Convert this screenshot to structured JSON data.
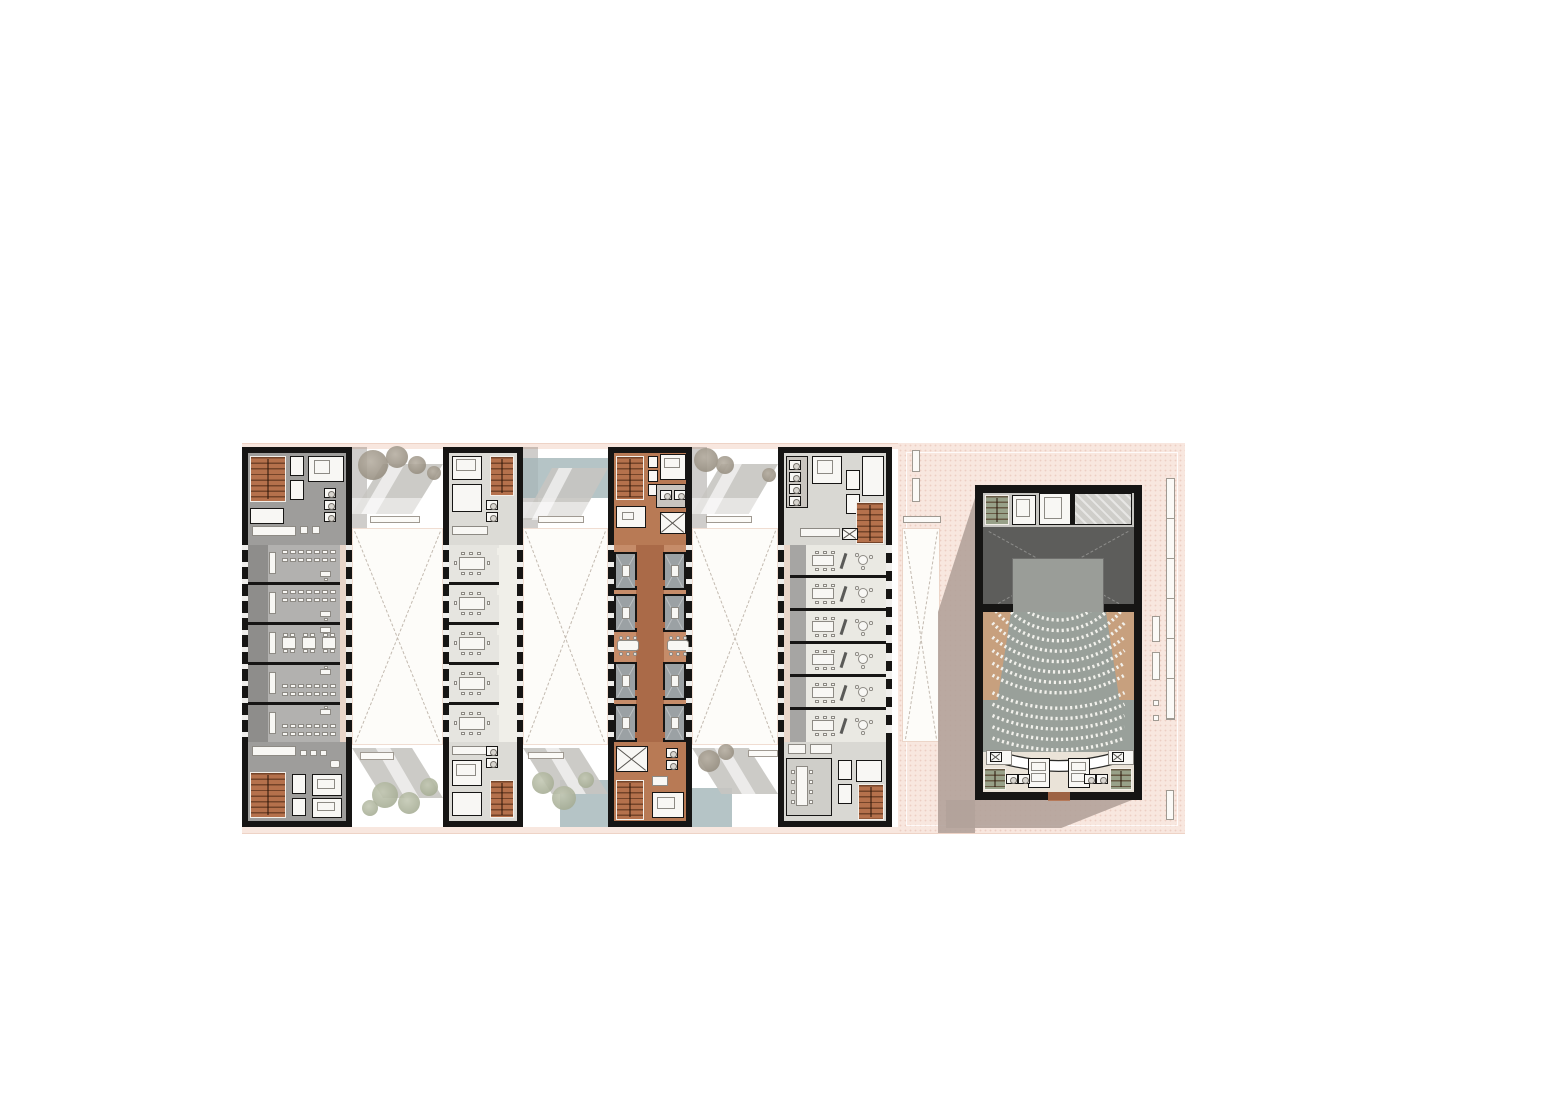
{
  "meta": {
    "kind": "architectural-floor-plan",
    "description": "Rendered ground-floor plan: four parallel building wings connected by landscaped courtyards, with a freestanding auditorium on a pink plaza at the right.",
    "visible_text": ""
  },
  "palette": {
    "wall": "#161514",
    "white": "#f8f7f4",
    "plaza": "#f8e7df",
    "plaza_line": "#eed3c6",
    "courtyard": "#fdfcf9",
    "courtyard_line": "#f0ddd2",
    "cross_dash": "#c3bab0",
    "stair": "#b5714c",
    "stair_tread": "rgba(62,30,12,0.55)",
    "green_stair": "#98a189",
    "shadow": "#b2a29a",
    "band_shadow": "rgba(95,88,82,0.30)",
    "path_grey": "#c6c5c1",
    "path_overlay": "rgba(255,255,255,0.62)",
    "water": "#a3b5b8",
    "tree_sage_1": "#c2c7b2",
    "tree_sage_2": "#a4ab92",
    "tree_taupe_1": "#b5ada0",
    "tree_taupe_2": "#948c7e",
    "bench": "#fbfaf7",
    "bench_line": "#a09a92",
    "gallery": "#e9d6ca",
    "bar1_floor": "#b2b1af",
    "bar1_corridor": "#8e8d8b",
    "bar1_core": "#9e9d9b",
    "bar2_floor": "#e6e5e0",
    "bar2_corridor": "#f0efe9",
    "bar2_core": "#dcdbd6",
    "bar3_floor": "#c68c69",
    "bar3_corridor": "#aa6a48",
    "bar3_room": "#9ba1a4",
    "bar3_core": "#b87a55",
    "bar4_floor": "#eae9e3",
    "bar4_corridor": "#a6a5a3",
    "bar4_core": "#d9d8d3",
    "bar4_pantry": "#cfcec9",
    "furniture": "#f8f7f4",
    "furniture_line": "#8d8a84",
    "divider": "#5a5a58",
    "wc_floor": "#c9c5bf",
    "backstage": "#c7c6c2",
    "stage": "#5d5d5b",
    "stage_dash": "#8d8d8b",
    "apron": "#9a9d98",
    "apron_line": "#6f6f6d",
    "seating": "#99a09a",
    "seat": "#f2f1ec",
    "wedge": "#c7a07e",
    "lobby": "#eae3d8",
    "counter_edge": "#2c2c2a",
    "entry": "#b5714c"
  },
  "wings": [
    {
      "id": "classroom-wing",
      "use": "classrooms",
      "rooms": 5,
      "seat_rows_per_room": 2,
      "seats_per_row": 7
    },
    {
      "id": "seminar-wing",
      "use": "meeting rooms",
      "rooms": 5,
      "chairs_per_table": 8
    },
    {
      "id": "study-wing",
      "use": "study rooms",
      "rooms_per_side": 4,
      "communal_tables": 2
    },
    {
      "id": "office-wing",
      "use": "offices",
      "rooms": 6
    }
  ],
  "auditorium": {
    "seat_rows": 13,
    "cross_aisle_after_row": 8,
    "has_stage": true,
    "stage_cross_braces": true,
    "lobby_counter": true
  },
  "courtyards": [
    {
      "id": "courtyard-a",
      "skylight_cross": true
    },
    {
      "id": "courtyard-b",
      "skylight_cross": true
    },
    {
      "id": "courtyard-c",
      "skylight_cross": true
    },
    {
      "id": "plaza-skylight",
      "skylight_cross": true
    }
  ],
  "plaza": {
    "benches": [
      [
        912,
        450,
        8,
        22
      ],
      [
        912,
        478,
        8,
        24
      ],
      [
        903,
        516,
        38,
        7
      ],
      [
        1166,
        478,
        9,
        242
      ],
      [
        1152,
        616,
        8,
        26
      ],
      [
        1152,
        652,
        8,
        28
      ],
      [
        1153,
        700,
        6,
        6
      ],
      [
        1153,
        715,
        6,
        6
      ],
      [
        1166,
        790,
        8,
        30
      ]
    ]
  },
  "landscape": {
    "trees": [
      {
        "x": 358,
        "y": 450,
        "d": 30,
        "tone": "taupe"
      },
      {
        "x": 386,
        "y": 446,
        "d": 22,
        "tone": "taupe"
      },
      {
        "x": 408,
        "y": 456,
        "d": 18,
        "tone": "taupe"
      },
      {
        "x": 427,
        "y": 466,
        "d": 14,
        "tone": "taupe"
      },
      {
        "x": 694,
        "y": 448,
        "d": 24,
        "tone": "taupe"
      },
      {
        "x": 716,
        "y": 456,
        "d": 18,
        "tone": "taupe"
      },
      {
        "x": 762,
        "y": 468,
        "d": 14,
        "tone": "taupe"
      },
      {
        "x": 372,
        "y": 782,
        "d": 26,
        "tone": "sage"
      },
      {
        "x": 398,
        "y": 792,
        "d": 22,
        "tone": "sage"
      },
      {
        "x": 420,
        "y": 778,
        "d": 18,
        "tone": "sage"
      },
      {
        "x": 362,
        "y": 800,
        "d": 16,
        "tone": "sage"
      },
      {
        "x": 532,
        "y": 772,
        "d": 22,
        "tone": "sage"
      },
      {
        "x": 552,
        "y": 786,
        "d": 24,
        "tone": "sage"
      },
      {
        "x": 578,
        "y": 772,
        "d": 16,
        "tone": "sage"
      },
      {
        "x": 698,
        "y": 750,
        "d": 22,
        "tone": "taupe"
      },
      {
        "x": 718,
        "y": 744,
        "d": 16,
        "tone": "taupe"
      }
    ],
    "water": [
      [
        523,
        458,
        85,
        40
      ],
      [
        560,
        780,
        48,
        47
      ],
      [
        692,
        788,
        40,
        39
      ]
    ],
    "path_benches": [
      [
        370,
        516,
        50,
        7
      ],
      [
        538,
        516,
        46,
        7
      ],
      [
        706,
        516,
        46,
        7
      ],
      [
        360,
        752,
        34,
        8
      ],
      [
        528,
        752,
        36,
        7
      ],
      [
        748,
        750,
        30,
        7
      ]
    ]
  }
}
